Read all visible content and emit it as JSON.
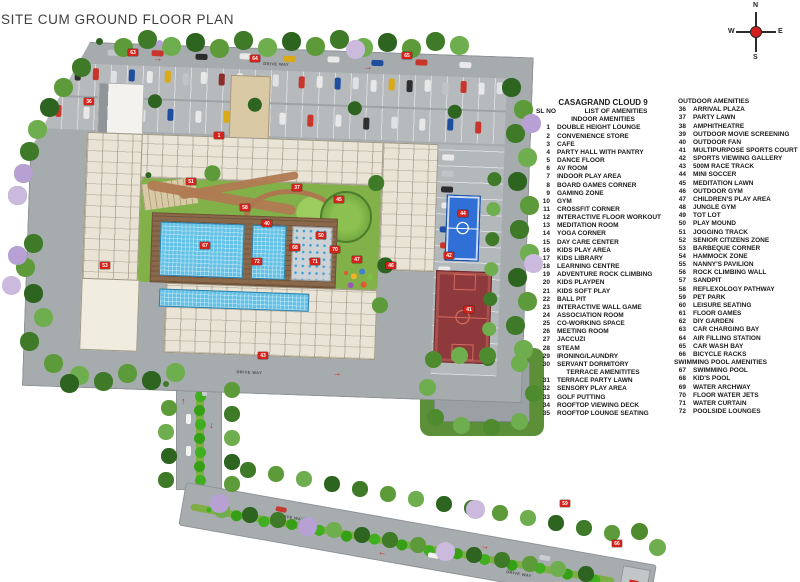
{
  "page": {
    "title": "SITE CUM GROUND FLOOR PLAN"
  },
  "compass": {
    "north": "N",
    "south": "S",
    "east": "E",
    "west": "W"
  },
  "legend": {
    "project_title": "CASAGRAND CLOUD 9",
    "sl_no_label": "SL NO",
    "list_label": "LIST OF AMENITIES",
    "col1": [
      {
        "heading": "INDOOR AMENITIES",
        "items": [
          {
            "no": "1",
            "label": "DOUBLE HEIGHT LOUNGE"
          },
          {
            "no": "2",
            "label": "CONVENIENCE STORE"
          },
          {
            "no": "3",
            "label": "CAFE"
          },
          {
            "no": "4",
            "label": "PARTY HALL WITH PANTRY"
          },
          {
            "no": "5",
            "label": "DANCE FLOOR"
          },
          {
            "no": "6",
            "label": "AV ROOM"
          },
          {
            "no": "7",
            "label": "INDOOR PLAY AREA"
          },
          {
            "no": "8",
            "label": "BOARD GAMES CORNER"
          },
          {
            "no": "9",
            "label": "GAMING ZONE"
          },
          {
            "no": "10",
            "label": "GYM"
          },
          {
            "no": "11",
            "label": "CROSSFIT CORNER"
          },
          {
            "no": "12",
            "label": "INTERACTIVE FLOOR WORKOUT"
          },
          {
            "no": "13",
            "label": "MEDITATION ROOM"
          },
          {
            "no": "14",
            "label": "YOGA CORNER"
          },
          {
            "no": "15",
            "label": "DAY CARE CENTER"
          },
          {
            "no": "16",
            "label": "KIDS PLAY AREA"
          },
          {
            "no": "17",
            "label": "KIDS LIBRARY"
          },
          {
            "no": "18",
            "label": "LEARNING CENTRE"
          },
          {
            "no": "19",
            "label": "ADVENTURE ROCK CLIMBING"
          },
          {
            "no": "20",
            "label": "KIDS PLAYPEN"
          },
          {
            "no": "21",
            "label": "KIDS SOFT PLAY"
          },
          {
            "no": "22",
            "label": "BALL PIT"
          },
          {
            "no": "23",
            "label": "INTERACTIVE WALL GAME"
          },
          {
            "no": "24",
            "label": "ASSOCIATION ROOM"
          },
          {
            "no": "25",
            "label": "CO-WORKING SPACE"
          },
          {
            "no": "26",
            "label": "MEETING ROOM"
          },
          {
            "no": "27",
            "label": "JACCUZI"
          },
          {
            "no": "28",
            "label": "STEAM"
          },
          {
            "no": "29",
            "label": "IRONING/LAUNDRY"
          },
          {
            "no": "30",
            "label": "SERVANT DORMITORY"
          }
        ]
      },
      {
        "heading": "TERRACE AMENITITES",
        "items": [
          {
            "no": "31",
            "label": "TERRACE PARTY LAWN"
          },
          {
            "no": "32",
            "label": "SENSORY PLAY AREA"
          },
          {
            "no": "33",
            "label": "GOLF PUTTING"
          },
          {
            "no": "34",
            "label": "ROOFTOP VIEWING DECK"
          },
          {
            "no": "35",
            "label": "ROOFTOP LOUNGE SEATING"
          }
        ]
      }
    ],
    "col2": [
      {
        "heading": "OUTDOOR AMENITIES",
        "items": [
          {
            "no": "36",
            "label": "ARRIVAL PLAZA"
          },
          {
            "no": "37",
            "label": "PARTY LAWN"
          },
          {
            "no": "38",
            "label": "AMPHITHEATRE"
          },
          {
            "no": "39",
            "label": "OUTDOOR MOVIE SCREENING"
          },
          {
            "no": "40",
            "label": "OUTDOOR FAN"
          },
          {
            "no": "41",
            "label": "MULTIPURPOSE SPORTS COURT"
          },
          {
            "no": "42",
            "label": "SPORTS VIEWING GALLERY"
          },
          {
            "no": "43",
            "label": "500M RACE TRACK"
          },
          {
            "no": "44",
            "label": "MINI SOCCER"
          },
          {
            "no": "45",
            "label": "MEDITATION LAWN"
          },
          {
            "no": "46",
            "label": "OUTDOOR GYM"
          },
          {
            "no": "47",
            "label": "CHILDREN'S PLAY AREA"
          },
          {
            "no": "48",
            "label": "JUNGLE GYM"
          },
          {
            "no": "49",
            "label": "TOT LOT"
          },
          {
            "no": "50",
            "label": "PLAY MOUND"
          },
          {
            "no": "51",
            "label": "JOGGING TRACK"
          },
          {
            "no": "52",
            "label": "SENIOR CITIZENS ZONE"
          },
          {
            "no": "53",
            "label": "BARBEQUE CORNER"
          },
          {
            "no": "54",
            "label": "HAMMOCK ZONE"
          },
          {
            "no": "55",
            "label": "NANNY'S PAVILION"
          },
          {
            "no": "56",
            "label": "ROCK CLIMBING WALL"
          },
          {
            "no": "57",
            "label": "SANDPIT"
          },
          {
            "no": "58",
            "label": "REFLEXOLOGY PATHWAY"
          },
          {
            "no": "59",
            "label": "PET PARK"
          },
          {
            "no": "60",
            "label": "LEISURE SEATING"
          },
          {
            "no": "61",
            "label": "FLOOR GAMES"
          },
          {
            "no": "62",
            "label": "DIY GARDEN"
          },
          {
            "no": "63",
            "label": "CAR CHARGING BAY"
          },
          {
            "no": "64",
            "label": "AIR FILLING STATION"
          },
          {
            "no": "65",
            "label": "CAR WASH BAY"
          },
          {
            "no": "66",
            "label": "BICYCLE RACKS"
          }
        ]
      },
      {
        "heading": "SWIMMING POOL AMENITIES",
        "items": [
          {
            "no": "67",
            "label": "SWIMMING POOL"
          },
          {
            "no": "68",
            "label": "KID'S POOL"
          },
          {
            "no": "69",
            "label": "WATER ARCHWAY"
          },
          {
            "no": "70",
            "label": "FLOOR WATER JETS"
          },
          {
            "no": "71",
            "label": "WATER CURTAIN"
          },
          {
            "no": "72",
            "label": "POOLSIDE LOUNGES"
          }
        ]
      }
    ]
  },
  "plan": {
    "substation_label": "SUBSTATION",
    "drive_way_label": "DRIVE WAY",
    "markers": [
      {
        "no": "36",
        "x": 84,
        "y": 98
      },
      {
        "no": "63",
        "x": 128,
        "y": 49
      },
      {
        "no": "64",
        "x": 250,
        "y": 55
      },
      {
        "no": "65",
        "x": 402,
        "y": 52
      },
      {
        "no": "1",
        "x": 214,
        "y": 132
      },
      {
        "no": "51",
        "x": 186,
        "y": 178
      },
      {
        "no": "37",
        "x": 292,
        "y": 184
      },
      {
        "no": "45",
        "x": 334,
        "y": 196
      },
      {
        "no": "58",
        "x": 240,
        "y": 204
      },
      {
        "no": "40",
        "x": 262,
        "y": 220
      },
      {
        "no": "50",
        "x": 316,
        "y": 232
      },
      {
        "no": "67",
        "x": 200,
        "y": 242
      },
      {
        "no": "68",
        "x": 290,
        "y": 244
      },
      {
        "no": "70",
        "x": 330,
        "y": 246
      },
      {
        "no": "71",
        "x": 310,
        "y": 258
      },
      {
        "no": "72",
        "x": 252,
        "y": 258
      },
      {
        "no": "47",
        "x": 352,
        "y": 256
      },
      {
        "no": "44",
        "x": 458,
        "y": 210
      },
      {
        "no": "41",
        "x": 464,
        "y": 306
      },
      {
        "no": "42",
        "x": 444,
        "y": 252
      },
      {
        "no": "53",
        "x": 100,
        "y": 262
      },
      {
        "no": "46",
        "x": 386,
        "y": 262
      },
      {
        "no": "43",
        "x": 258,
        "y": 352
      },
      {
        "no": "59",
        "x": 560,
        "y": 500
      },
      {
        "no": "66",
        "x": 612,
        "y": 540
      }
    ]
  },
  "colors": {
    "road": "#a7acaf",
    "lawn": "#82b14a",
    "pool": "#62c1e6",
    "deck": "#8a684a",
    "blue_court": "#2f6fd6",
    "basketball_court": "#8e3a3c",
    "marker_red": "#d4231b",
    "tree_green": "#3e7a28",
    "tree_purple": "#b7a1d4"
  }
}
